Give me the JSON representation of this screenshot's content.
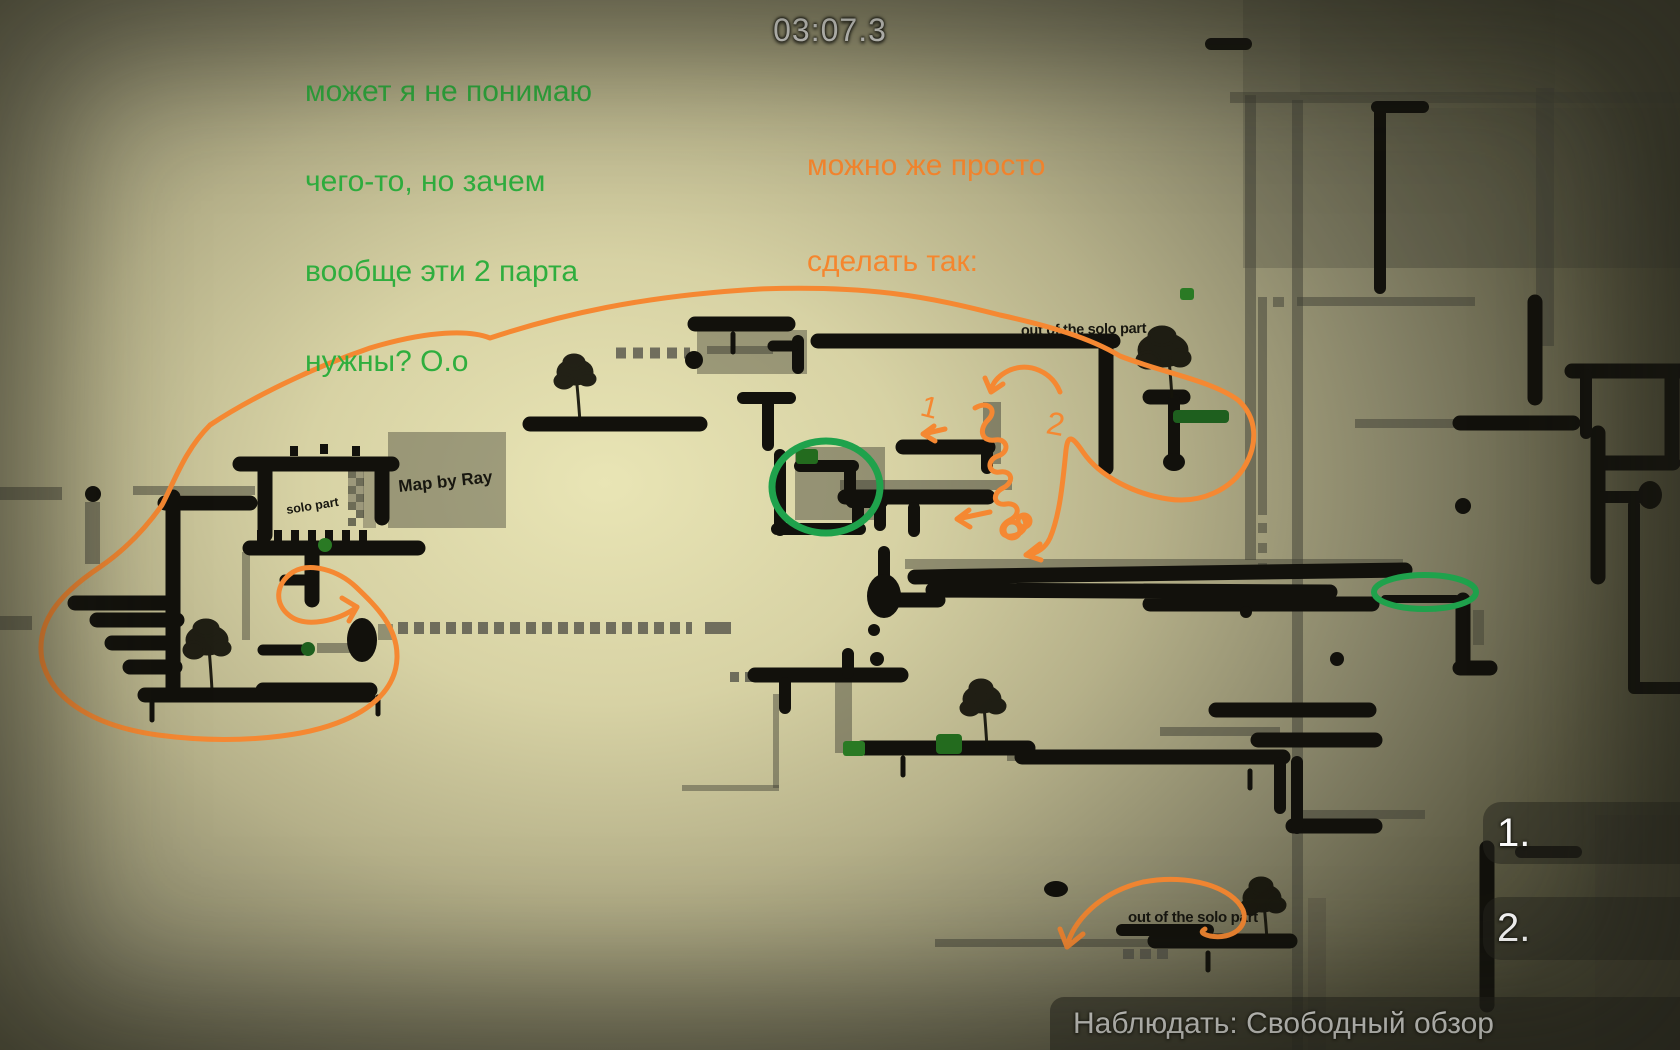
{
  "ui": {
    "timer": "03:07.3",
    "spectate_bar_text": "Наблюдать: Свободный обзор",
    "spectator_slots": [
      {
        "label": "1."
      },
      {
        "label": "2."
      }
    ],
    "colors": {
      "green_note": "#2fae3e",
      "orange_note": "#f5862e",
      "annotation_orange": "#f58832",
      "circle_green": "#1fa24c",
      "timer_text": "#f1f1ed",
      "panel_bg": "rgba(34,34,27,0.55)",
      "platform_black": "#12110c",
      "item_green": "#236b1e"
    }
  },
  "notes": {
    "green": {
      "lines": [
        "может я не понимаю",
        "чего-то, но зачем",
        "вообще эти 2 парта",
        "нужны? O.o"
      ]
    },
    "orange": {
      "lines": [
        "можно же просто",
        "сделать так:"
      ]
    }
  },
  "map_labels": {
    "out_top": "out of the solo part",
    "out_bottom": "out of the solo part",
    "credit": "Map by Ray",
    "solo": "solo part"
  },
  "annotations": {
    "handwritten_1": "1",
    "handwritten_2": "2"
  }
}
